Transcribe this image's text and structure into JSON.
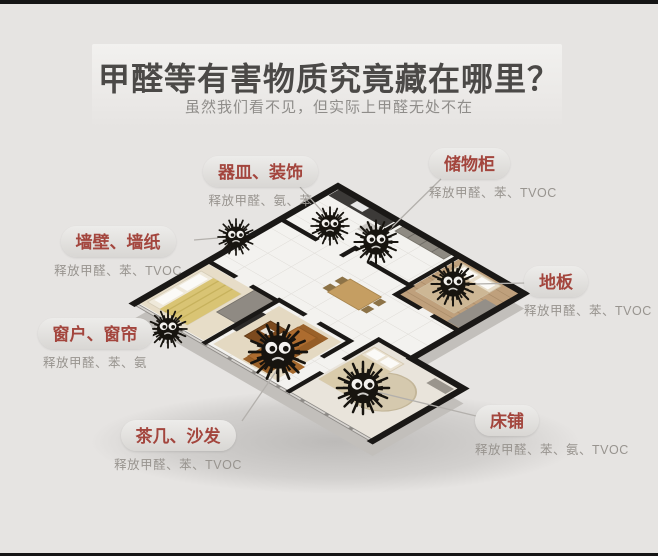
{
  "page": {
    "title": "甲醛等有害物质究竟藏在哪里？",
    "subtitle": "虽然我们看不见，但实际上甲醛无处不在"
  },
  "callouts": [
    {
      "label": "器皿、装饰",
      "sub": "释放甲醛、氨、苯"
    },
    {
      "label": "储物柜",
      "sub": "释放甲醛、苯、TVOC"
    },
    {
      "label": "墙壁、墙纸",
      "sub": "释放甲醛、苯、TVOC"
    },
    {
      "label": "地板",
      "sub": "释放甲醛、苯、TVOC"
    },
    {
      "label": "窗户、窗帘",
      "sub": "释放甲醛、苯、氨"
    },
    {
      "label": "茶几、沙发",
      "sub": "释放甲醛、苯、TVOC"
    },
    {
      "label": "床铺",
      "sub": "释放甲醛、苯、氨、TVOC"
    }
  ],
  "colors": {
    "label_text": "#a3453d",
    "sub_text": "#98948f",
    "title_text": "#4b4947",
    "background": "#e6e4e2",
    "frame_bar": "#151515"
  },
  "icons": {
    "hazard": "germ-monster-icon"
  }
}
